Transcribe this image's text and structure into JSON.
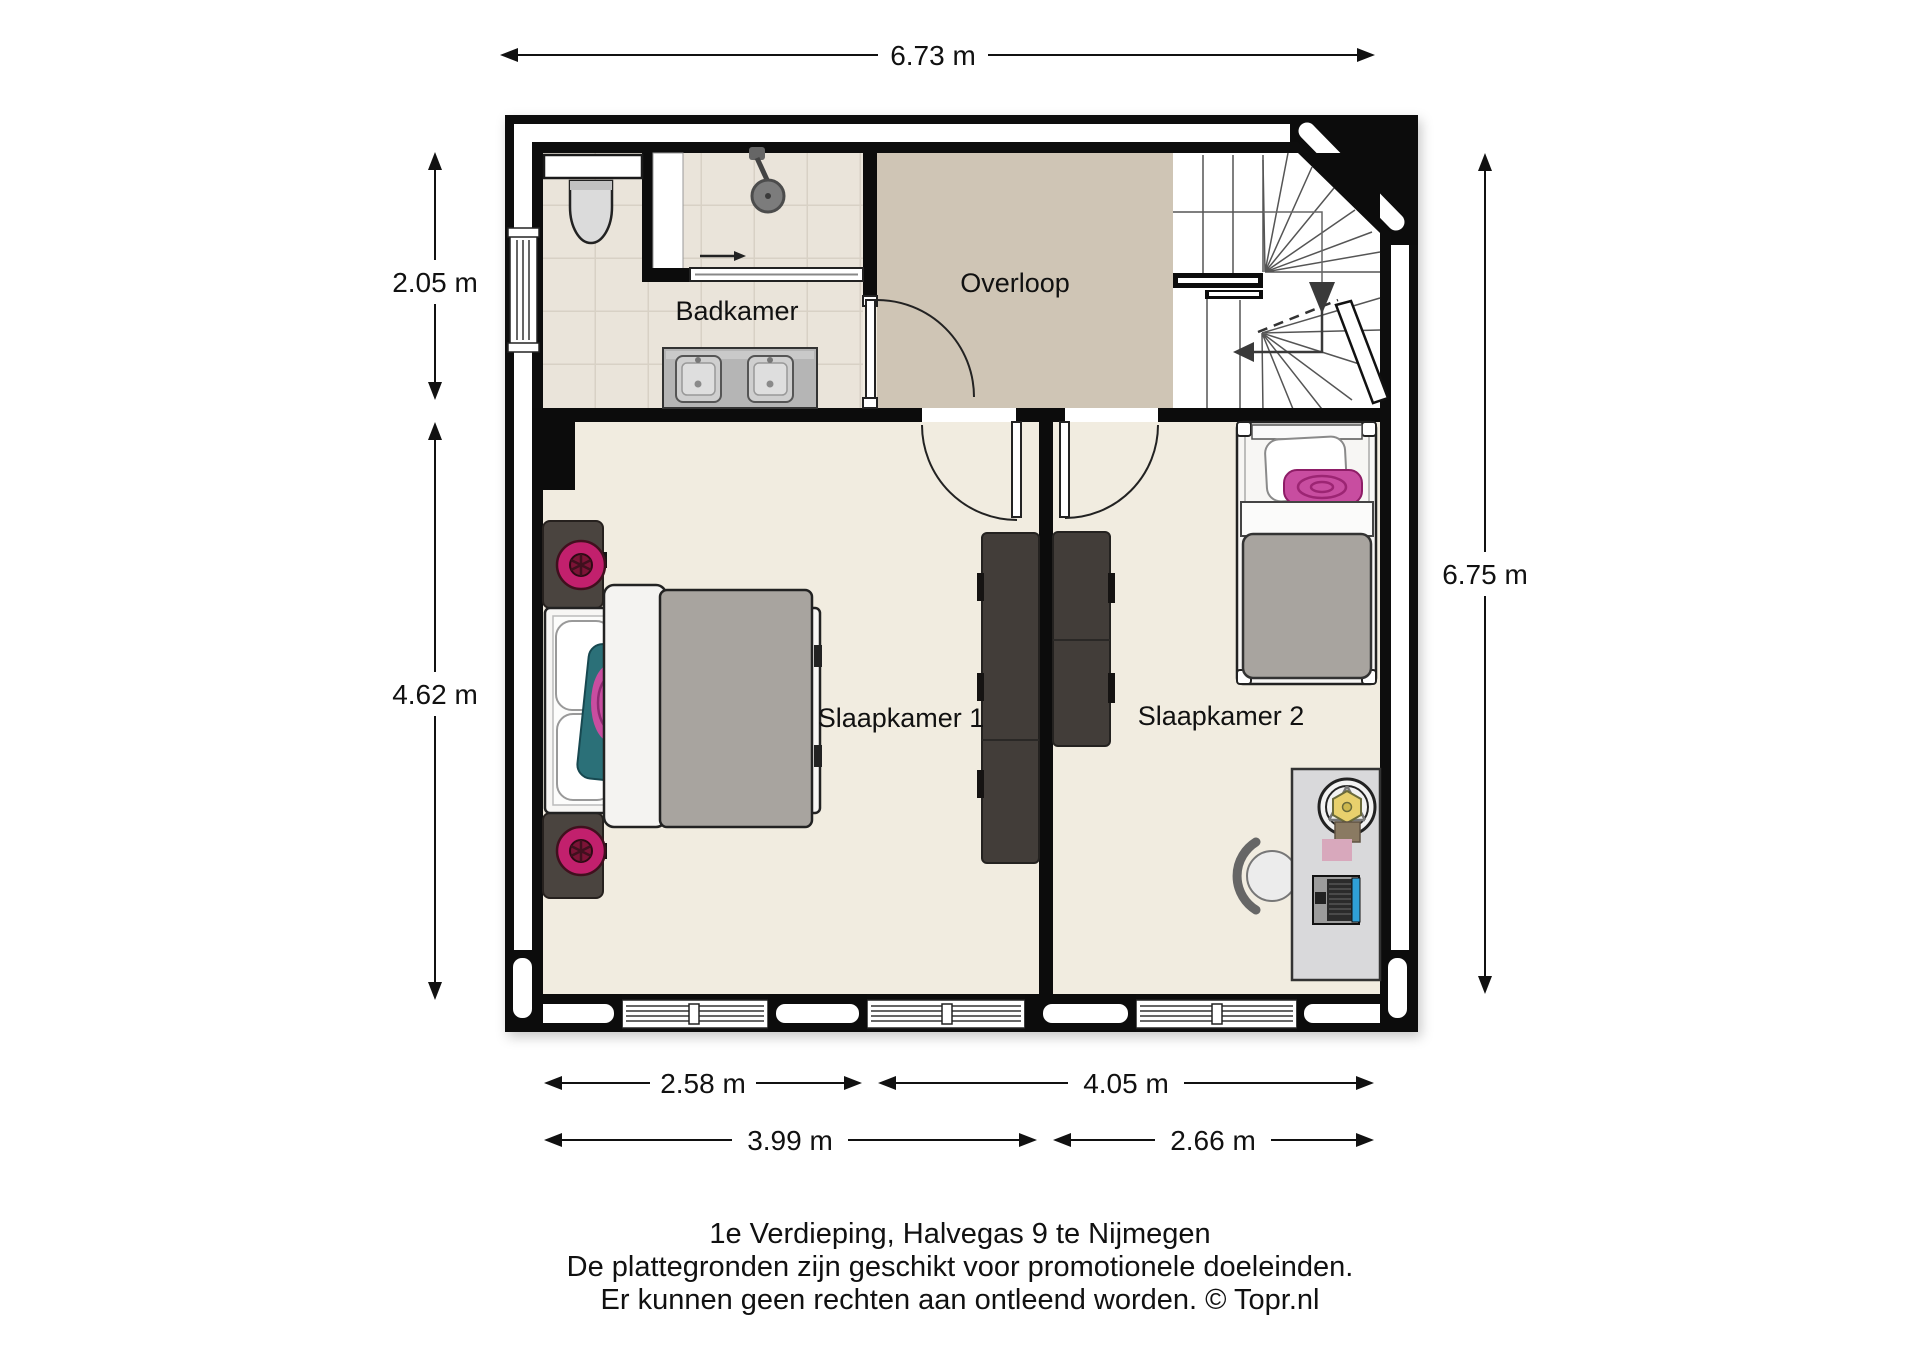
{
  "room_labels": {
    "badkamer": "Badkamer",
    "overloop": "Overloop",
    "slaapkamer1": "Slaapkamer 1",
    "slaapkamer2": "Slaapkamer 2"
  },
  "dimensions": {
    "top": "6.73 m",
    "left_upper": "2.05 m",
    "left_lower": "4.62 m",
    "right": "6.75 m",
    "bottom_row1_left": "2.58 m",
    "bottom_row1_right": "4.05 m",
    "bottom_row2_left": "3.99 m",
    "bottom_row2_right": "2.66 m"
  },
  "caption": {
    "line1": "1e Verdieping, Halvegas 9 te Nijmegen",
    "line2": "De plattegronden zijn geschikt voor promotionele doeleinden.",
    "line3": "Er kunnen geen rechten aan ontleend worden. © Topr.nl"
  },
  "colors": {
    "wall": "#0c0c0c",
    "cavity": "#ffffff",
    "floor_bedroom": "#f1ece0",
    "floor_bathroom": "#eae4da",
    "tile_line": "#d8d1c5",
    "floor_overloop": "#cfc5b5",
    "furniture_dark": "#423d39",
    "nightstand_dark": "#4a443f",
    "lamp_pink": "#c2206d",
    "lamp_pink_dark": "#7c1336",
    "pillow_teal": "#2b7078",
    "rose_pink": "#c84da0",
    "duvet_gray": "#a8a49f",
    "bed_white": "#f7f6f4",
    "desk_gray": "#d9d9db",
    "lamp_yellow": "#e8d06d",
    "laptop_blue": "#2f9fd6",
    "dim_text": "#111111"
  }
}
